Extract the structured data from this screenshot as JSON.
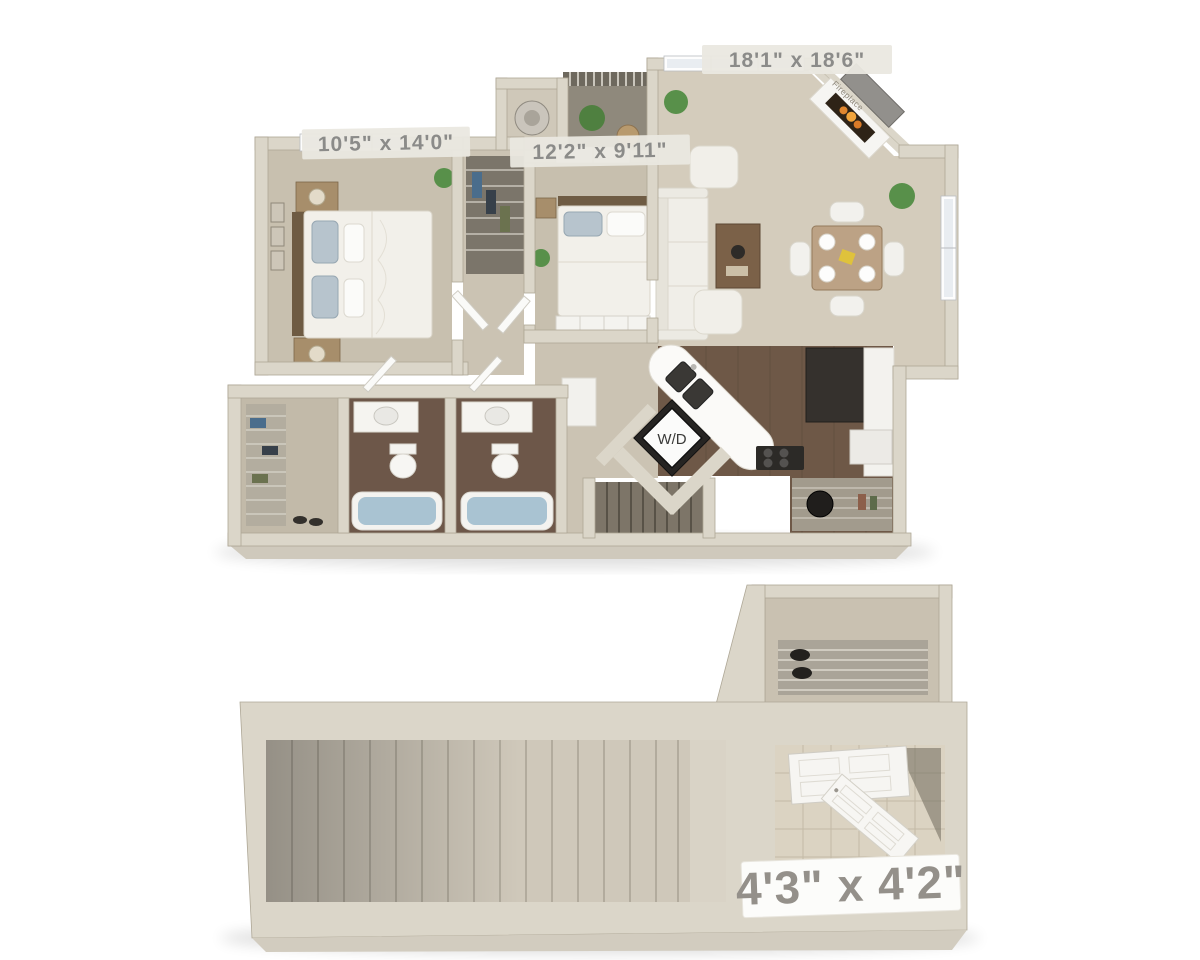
{
  "title": "Two-level apartment 3D floor plan",
  "labels": {
    "living": "18'1\" x 18'6\"",
    "bedroom1": "10'5\" x 14'0\"",
    "bedroom2": "12'2\" x 9'11\"",
    "washer_dryer": "W/D",
    "fireplace": "Fireplace",
    "entry": "4'3\" x 4'2\""
  },
  "upper_floor": {
    "rooms": [
      {
        "name": "bedroom-1",
        "dimensions": "10'5\" x 14'0\"",
        "fixtures": [
          "bed",
          "nightstands",
          "lamps",
          "wall-pictures",
          "window"
        ]
      },
      {
        "name": "bedroom-2",
        "dimensions": "12'2\" x 9'11\"",
        "fixtures": [
          "bed",
          "dresser",
          "window"
        ]
      },
      {
        "name": "living-room",
        "dimensions": "18'1\" x 18'6\"",
        "fixtures": [
          "fireplace",
          "tv",
          "sofa",
          "armchairs",
          "coffee-table",
          "dining-table",
          "chairs",
          "plants",
          "windows"
        ]
      },
      {
        "name": "kitchen",
        "fixtures": [
          "angled-island-sink",
          "stove",
          "refrigerator",
          "counters",
          "pantry-shelving"
        ]
      },
      {
        "name": "laundry",
        "label": "W/D",
        "fixtures": [
          "stacked-washer-dryer"
        ]
      },
      {
        "name": "bathroom-1",
        "fixtures": [
          "vanity",
          "toilet",
          "bathtub"
        ]
      },
      {
        "name": "bathroom-2",
        "fixtures": [
          "vanity",
          "toilet",
          "bathtub"
        ]
      },
      {
        "name": "walk-in-closet",
        "fixtures": [
          "wire-shelving",
          "clothes"
        ]
      },
      {
        "name": "balcony",
        "fixtures": [
          "railing",
          "plant",
          "table"
        ]
      },
      {
        "name": "water-heater-closet",
        "fixtures": [
          "water-heater"
        ]
      },
      {
        "name": "interior-stairs",
        "fixtures": [
          "steps-down"
        ]
      }
    ]
  },
  "entry_level": {
    "rooms": [
      {
        "name": "entry-foyer",
        "dimensions": "4'3\" x 4'2\"",
        "fixtures": [
          "front-door",
          "interior-door",
          "tile-floor"
        ]
      },
      {
        "name": "stairwell",
        "fixtures": [
          "staircase"
        ]
      },
      {
        "name": "entry-closet",
        "fixtures": [
          "wire-shelving",
          "shoes"
        ]
      }
    ]
  },
  "colors": {
    "background": "#ffffff",
    "wall": "#dbd6c9",
    "carpet": "#c8c0af",
    "living_floor": "#d4ccbc",
    "wood_floor": "#6e5847",
    "tile_floor": "#dbd3c2",
    "label_text": "#8b8b89",
    "entry_label_text": "#94908a",
    "plant": "#58904a",
    "bath_water": "#a9c3d2",
    "appliance_dark": "#262422",
    "pillow_blue": "#b7c4cd"
  }
}
